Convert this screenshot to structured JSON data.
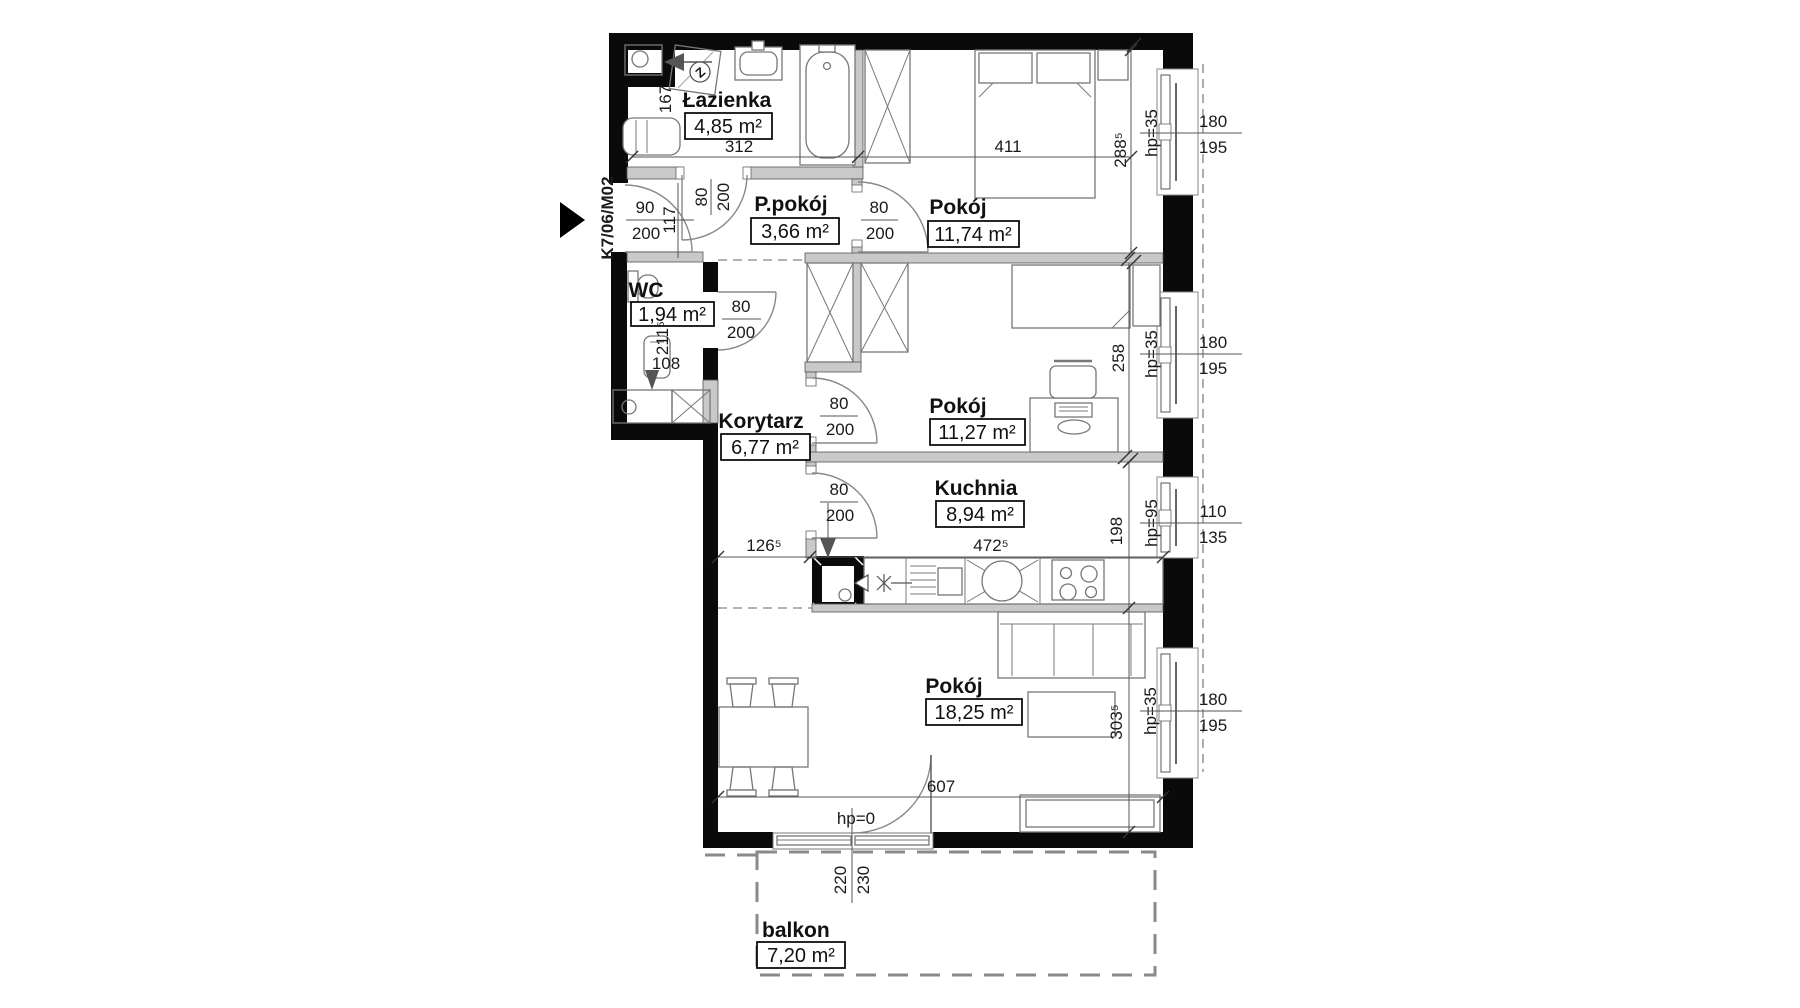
{
  "unit_label": "K7/06/M02",
  "rooms": {
    "lazienka": {
      "name": "Łazienka",
      "area": "4,85 m²"
    },
    "ppokoj": {
      "name": "P.pokój",
      "area": "3,66 m²"
    },
    "pokoj_a": {
      "name": "Pokój",
      "area": "11,74 m²"
    },
    "wc": {
      "name": "WC",
      "area": "1,94 m²"
    },
    "korytarz": {
      "name": "Korytarz",
      "area": "6,77 m²"
    },
    "pokoj_b": {
      "name": "Pokój",
      "area": "11,27 m²"
    },
    "kuchnia": {
      "name": "Kuchnia",
      "area": "8,94 m²"
    },
    "pokoj_c": {
      "name": "Pokój",
      "area": "18,25 m²"
    },
    "balkon": {
      "name": "balkon",
      "area": "7,20 m²"
    }
  },
  "dims": {
    "bath_width": "312",
    "bath_side": "167",
    "room_a_width": "411",
    "room_a_depth": "288⁵",
    "entry_w": "90",
    "entry_h": "200",
    "entry_side": "117",
    "door_w": "80",
    "door_h": "200",
    "wc_depth": "211⁵",
    "wc_width": "108",
    "room_b_depth": "258",
    "hall_width": "126⁵",
    "kitchen_width": "472⁵",
    "kitchen_depth": "198",
    "room_c_depth": "303⁵",
    "room_c_width": "607",
    "balcony_door_w": "220",
    "balcony_door_h": "230"
  },
  "windows": {
    "w1": {
      "hp": "hp=35",
      "h1": "180",
      "h2": "195"
    },
    "w2": {
      "hp": "hp=35",
      "h1": "180",
      "h2": "195"
    },
    "w3": {
      "hp": "hp=95",
      "h1": "110",
      "h2": "135"
    },
    "w4": {
      "hp": "hp=35",
      "h1": "180",
      "h2": "195"
    },
    "balcony_door": {
      "hp": "hp=0"
    }
  },
  "symbols": {
    "gas_meter": "Z"
  },
  "colors": {
    "wall": "#0a0a0a",
    "partition": "#c9c9c9",
    "line": "#777777",
    "dash": "#999999"
  }
}
